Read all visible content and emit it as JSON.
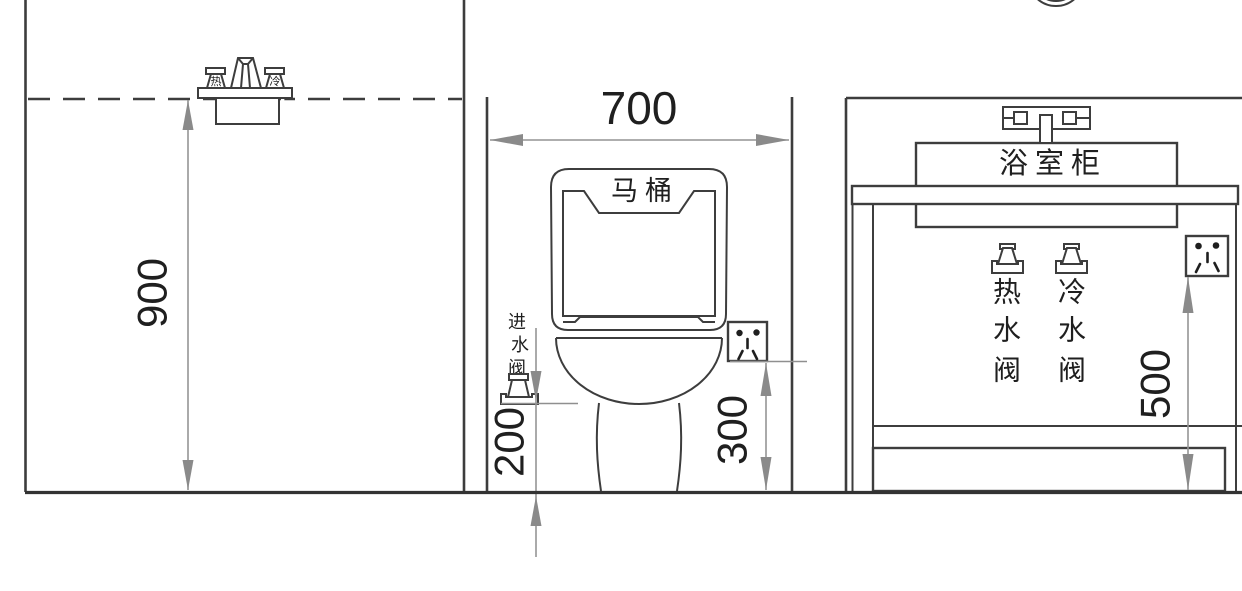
{
  "page": {
    "background": "#ffffff"
  },
  "colors": {
    "line": "#3d3d3d",
    "dimension_line": "#949494",
    "dimension_arrow": "#8a8a8a",
    "text": "#1f1f1f"
  },
  "dimensions": {
    "shower_mixer_height": "900",
    "toilet_bay_width": "700",
    "inlet_valve_height": "200",
    "toilet_socket_height": "300",
    "vanity_socket_height": "500"
  },
  "labels": {
    "toilet": "马桶",
    "bathroom_cabinet": "浴室柜",
    "inlet_valve_chars": [
      "进",
      "水",
      "阀"
    ],
    "hot_valve_chars": [
      "热",
      "水",
      "阀"
    ],
    "cold_valve_chars": [
      "冷",
      "水",
      "阀"
    ],
    "hot_handle": "热",
    "cold_handle": "冷"
  }
}
